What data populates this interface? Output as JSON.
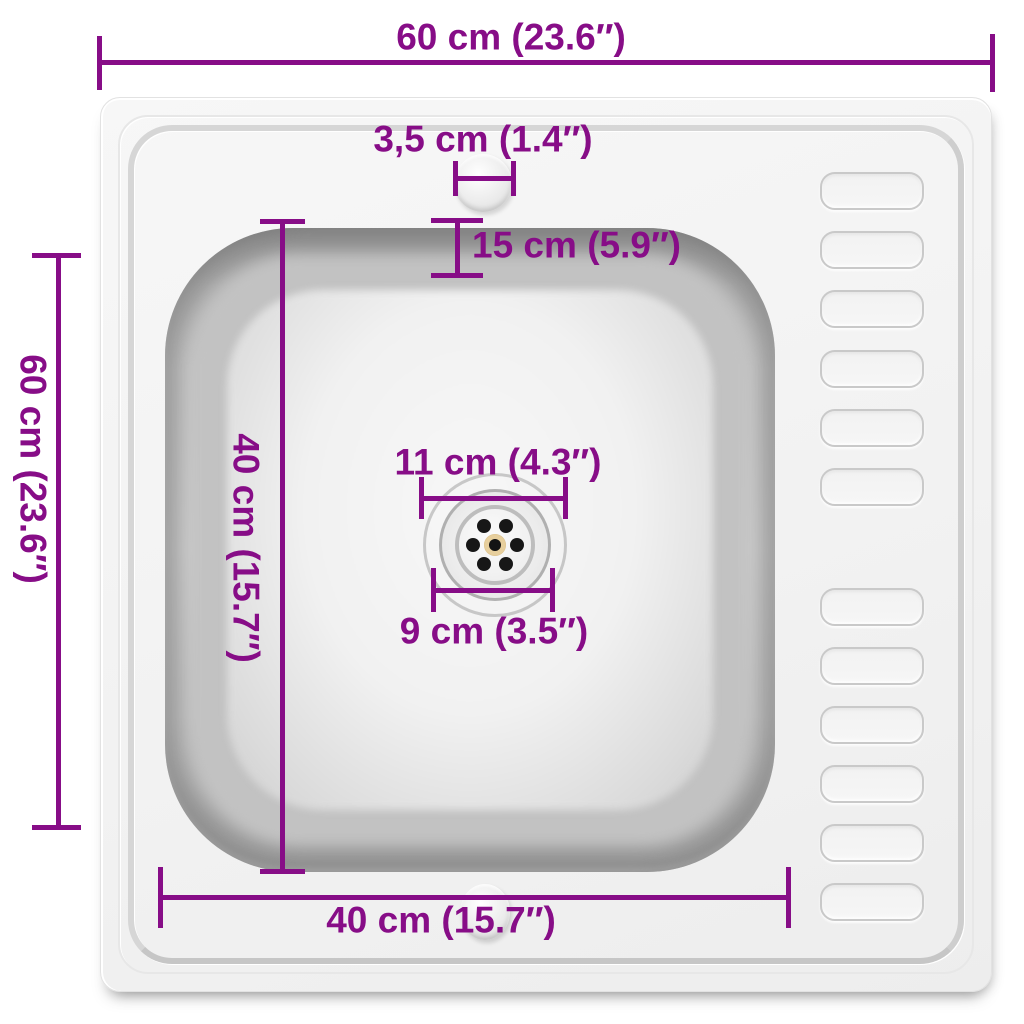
{
  "title": "Kitchen sink top-view dimension diagram",
  "colors": {
    "annotation": "#870D87",
    "background": "#FFFFFF",
    "sink_body": "#F3F3F3",
    "bowl_rim_gray": "#8D8D8D",
    "drain_screw_gold": "#E7CF9D"
  },
  "dimensions": {
    "overall_width": "60 cm (23.6″)",
    "overall_depth": "60 cm (23.6″)",
    "tap_hole_diameter": "3,5 cm (1.4″)",
    "tap_hole_offset": "15 cm (5.9″)",
    "bowl_depth": "40 cm (15.7″)",
    "bowl_width": "40 cm (15.7″)",
    "drain_flange_diameter": "11 cm (4.3″)",
    "drain_diameter": "9 cm (3.5″)"
  },
  "sink": {
    "bowl_count": 1,
    "drain_hole_count": 6,
    "drainboard_rib_rows_top": 6,
    "drainboard_rib_rows_bottom": 6
  }
}
